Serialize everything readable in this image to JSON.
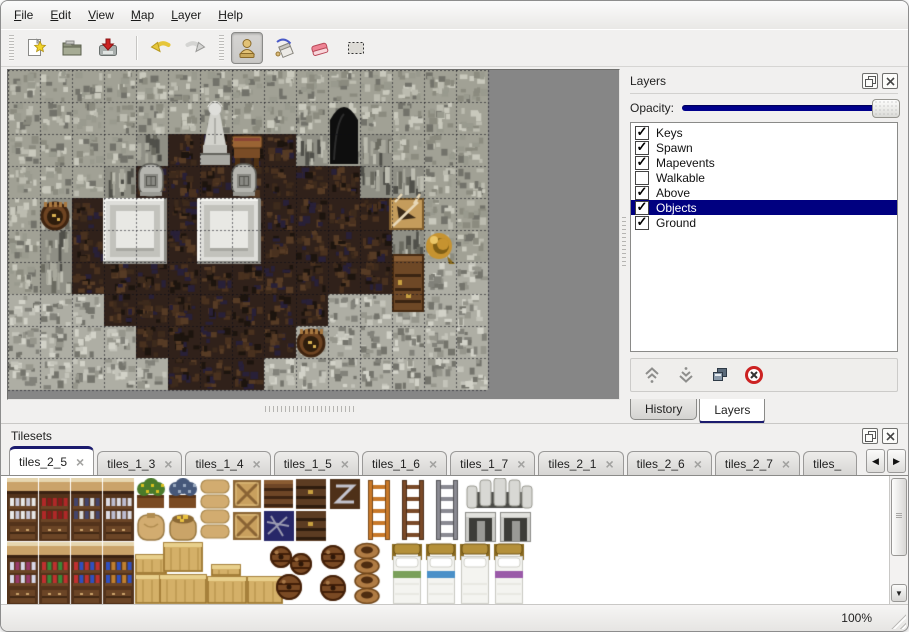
{
  "menu": {
    "items": [
      "File",
      "Edit",
      "View",
      "Map",
      "Layer",
      "Help"
    ]
  },
  "toolbar": {
    "icons": [
      "new-file",
      "open-folder",
      "save",
      "undo",
      "redo",
      "stamp-tool",
      "fill-tool",
      "eraser-tool",
      "select-tool"
    ],
    "active_tool": "stamp-tool"
  },
  "layers_panel": {
    "title": "Layers",
    "opacity_label": "Opacity:",
    "opacity_percent": 100,
    "layers": [
      {
        "label": "Keys",
        "checked": true,
        "selected": false
      },
      {
        "label": "Spawn",
        "checked": true,
        "selected": false
      },
      {
        "label": "Mapevents",
        "checked": true,
        "selected": false
      },
      {
        "label": "Walkable",
        "checked": false,
        "selected": false
      },
      {
        "label": "Above",
        "checked": true,
        "selected": false
      },
      {
        "label": "Objects",
        "checked": true,
        "selected": true
      },
      {
        "label": "Ground",
        "checked": true,
        "selected": false
      }
    ],
    "buttons": [
      "move-layer-up",
      "move-layer-down",
      "duplicate-layer",
      "delete-layer"
    ],
    "bottom_tabs": [
      {
        "label": "History",
        "active": false
      },
      {
        "label": "Layers",
        "active": true
      }
    ]
  },
  "tilesets_panel": {
    "title": "Tilesets",
    "tabs": [
      {
        "label": "tiles_2_5",
        "active": true
      },
      {
        "label": "tiles_1_3",
        "active": false
      },
      {
        "label": "tiles_1_4",
        "active": false
      },
      {
        "label": "tiles_1_5",
        "active": false
      },
      {
        "label": "tiles_1_6",
        "active": false
      },
      {
        "label": "tiles_1_7",
        "active": false
      },
      {
        "label": "tiles_2_1",
        "active": false
      },
      {
        "label": "tiles_2_6",
        "active": false
      },
      {
        "label": "tiles_2_7",
        "active": false
      },
      {
        "label": "tiles_",
        "active": false,
        "truncated": true
      }
    ]
  },
  "status_bar": {
    "zoom_level": "100%"
  },
  "colors": {
    "accent_navy": "#00008c",
    "selection": "#000080",
    "canvas_gray": "#868686"
  },
  "map": {
    "tile_size": 32,
    "cols": 15,
    "rows": 10,
    "legend": {
      "W": "rock-wall",
      "V": "rock-wall-face",
      "F": "dark-crypt-floor",
      "S": "stone-floor"
    },
    "tiles": [
      "WWWWWWWWWWWWWWW",
      "WWWWWWWWWWWWWWW",
      "WWWWVFFFFVWVWWW",
      "WWWVFFFFFFFVVWW",
      "WVFFFFFFFFFFVWW",
      "WVFFFFFFFFFFVWW",
      "WVFFFFFFFFFFSSS",
      "SSSFFFFFFFSSSSS",
      "SSSSFFFFFSSSSSS",
      "SSSSSFFFSSSSSSS"
    ],
    "objects": [
      [
        "cave",
        322,
        34,
        28,
        60
      ],
      [
        "statue",
        190,
        30,
        34,
        66
      ],
      [
        "table",
        223,
        62,
        32,
        36
      ],
      [
        "grave",
        128,
        94,
        30,
        32
      ],
      [
        "grave",
        221,
        94,
        30,
        32
      ],
      [
        "platform",
        95,
        128,
        64,
        66
      ],
      [
        "platform",
        189,
        128,
        64,
        66
      ],
      [
        "barrel",
        29,
        130,
        36,
        32
      ],
      [
        "crate",
        381,
        122,
        35,
        38
      ],
      [
        "horn",
        415,
        156,
        34,
        40
      ],
      [
        "cabinet",
        384,
        184,
        32,
        58
      ],
      [
        "barrel",
        285,
        257,
        36,
        32
      ]
    ]
  },
  "tileset_items": [
    [
      "shelf",
      0,
      0,
      "#e8e8e8",
      "#c8c8d8"
    ],
    [
      "shelf",
      32,
      0,
      "#b02828",
      "#8a1a1a"
    ],
    [
      "shelf",
      64,
      0,
      "#44446a",
      "#d8d8d8"
    ],
    [
      "shelf",
      96,
      0,
      "#dcdce4",
      "#bcbcd0"
    ],
    [
      "shelf",
      0,
      64,
      "#d8d8e8",
      "#9a3a6a"
    ],
    [
      "shelf",
      32,
      64,
      "#c03030",
      "#3a8a3a"
    ],
    [
      "shelf",
      64,
      64,
      "#c03030",
      "#3050c0"
    ],
    [
      "shelf",
      96,
      64,
      "#3050c0",
      "#c08030"
    ],
    [
      "planter",
      128,
      0,
      "#4a7a2a",
      "#d8c020"
    ],
    [
      "planter",
      160,
      0,
      "#46587a",
      "#9aaac0"
    ],
    [
      "sack",
      128,
      32
    ],
    [
      "sack_open",
      160,
      32
    ],
    [
      "sackpile",
      192,
      0
    ],
    [
      "cratex",
      224,
      0
    ],
    [
      "cratex",
      224,
      32
    ],
    [
      "darkcrate",
      256,
      0
    ],
    [
      "navy",
      256,
      32
    ],
    [
      "darkchest",
      288,
      0
    ],
    [
      "darkchest",
      288,
      32
    ],
    [
      "metalcrate",
      322,
      0
    ],
    [
      "ladder",
      356,
      0,
      "#c87828"
    ],
    [
      "ladder",
      390,
      0,
      "#7a4a28"
    ],
    [
      "ladder",
      424,
      0,
      "#8a8a92"
    ],
    [
      "arch",
      458,
      0
    ],
    [
      "doorway",
      458,
      34
    ],
    [
      "doorway",
      493,
      34
    ],
    [
      "lightcrate",
      128,
      76,
      32,
      20
    ],
    [
      "lightcrate",
      128,
      96,
      32,
      30
    ],
    [
      "lightcrate",
      156,
      64,
      40,
      30
    ],
    [
      "lightcrate",
      152,
      96,
      48,
      30
    ],
    [
      "lightcrate",
      204,
      86,
      30,
      12
    ],
    [
      "lightcrate",
      200,
      98,
      40,
      28
    ],
    [
      "lightcrate",
      240,
      98,
      36,
      28
    ],
    [
      "barrels3",
      260,
      64
    ],
    [
      "barrels2",
      310,
      64
    ],
    [
      "pots",
      344,
      64
    ],
    [
      "bed",
      384,
      64,
      "#7aa05a"
    ],
    [
      "bed",
      418,
      64,
      "#4a90c8"
    ],
    [
      "bed",
      452,
      64,
      "#ffffff"
    ],
    [
      "bed",
      486,
      64,
      "#9a5aa8"
    ]
  ]
}
